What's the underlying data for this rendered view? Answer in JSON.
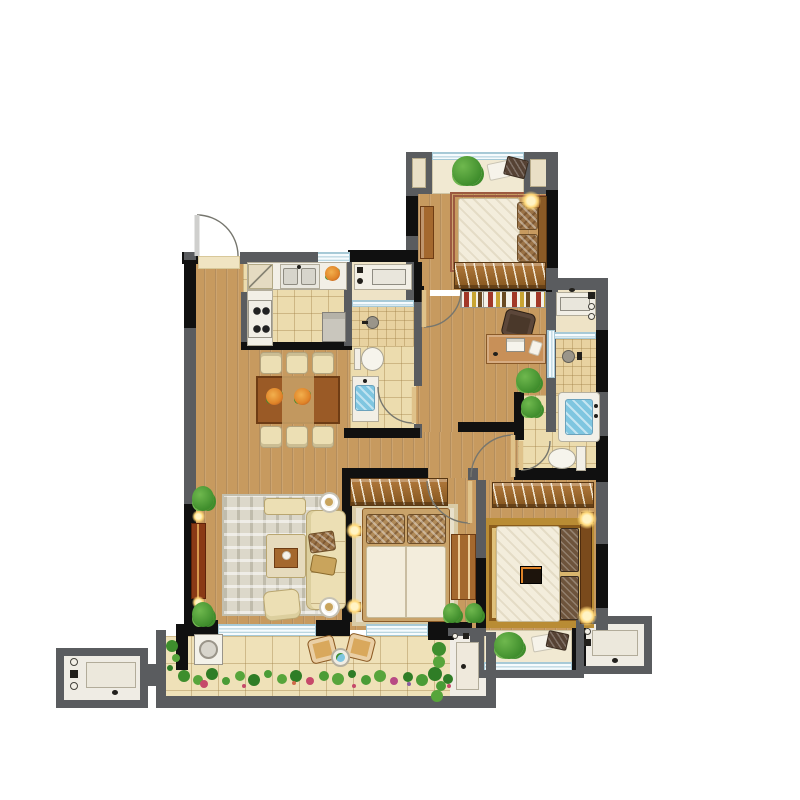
{
  "scene": {
    "type": "residential-apartment-floor-plan",
    "view": "top-down-rendered-plan",
    "visible_text": "none",
    "canvas": {
      "width": 800,
      "height": 800
    }
  },
  "palette": {
    "background": "#ffffff",
    "wall_gray": "#5a5c5f",
    "wall_black": "#101010",
    "wood_floor": "#c79a5f",
    "tile_floor": "#ecdcae",
    "tile_small": "#e8d2a0",
    "balcony_tile": "#efe1b8",
    "bay_marble": "#f1e9d2",
    "counter_white": "#f2efe6",
    "furniture_beige": "#ecdfb4",
    "furniture_wood": "#a4682e",
    "furniture_wood_dark": "#6e3c14",
    "tv_cabinet": "#8a3a16",
    "bedding_white": "#f3eddc",
    "pillow_brown": "#9a7246",
    "pillow_dark": "#564234",
    "rug_master": "#d9b66e",
    "rug_living": "#dcd8ca",
    "plant_green": "#3f8d2c",
    "plant_green_light": "#6fb84e",
    "flower_orange": "#e08428",
    "flower_pink": "#c6496a",
    "water_blue": "#7fc6e0",
    "window_line": "#a6c9d6",
    "window_glass": "#f6fbfd",
    "lamp_glow": "#ffd97a",
    "door_arc": "#76766e",
    "door_leaf": "#dfc28a"
  },
  "rooms": [
    {
      "id": "living-dining-room",
      "floor": "wood",
      "features": [
        "entry-door",
        "dining-table-6-chairs",
        "sofa-set",
        "coffee-table",
        "tv-cabinet",
        "area-rug",
        "balcony-sliding-door"
      ]
    },
    {
      "id": "kitchen",
      "floor": "tile",
      "features": [
        "double-sink",
        "4-burner-stove",
        "cabinet",
        "appliance"
      ]
    },
    {
      "id": "bathroom-1",
      "floor": "tile",
      "features": [
        "vanity",
        "glass-partition",
        "shower",
        "toilet",
        "basin-counter"
      ]
    },
    {
      "id": "bedroom-top-right",
      "floor": "wood",
      "features": [
        "bay-window",
        "double-bed",
        "wardrobe",
        "side-cabinet",
        "lamp"
      ]
    },
    {
      "id": "study",
      "floor": "wood",
      "features": [
        "bookshelf",
        "desk",
        "chair",
        "plant"
      ]
    },
    {
      "id": "hallway",
      "floor": "wood",
      "features": []
    },
    {
      "id": "bedroom-middle",
      "floor": "wood",
      "features": [
        "wardrobe",
        "double-bed",
        "rug",
        "lamps",
        "dresser",
        "window"
      ]
    },
    {
      "id": "master-bedroom",
      "floor": "wood",
      "features": [
        "wardrobe",
        "double-bed",
        "patterned-rug",
        "lamps",
        "bay-window"
      ]
    },
    {
      "id": "master-bathroom",
      "floor": "tile",
      "features": [
        "vanity",
        "glass-partition",
        "shower",
        "bathtub",
        "toilet",
        "plants"
      ]
    },
    {
      "id": "balcony",
      "floor": "large-tile",
      "features": [
        "washing-machine",
        "two-chairs",
        "round-table",
        "flower-bed",
        "utility-sink"
      ]
    },
    {
      "id": "equipment-platform-left",
      "floor": "white",
      "features": [
        "counter-sink"
      ]
    },
    {
      "id": "equipment-platform-right",
      "floor": "white",
      "features": [
        "counter-sink"
      ]
    }
  ],
  "doors": [
    "entry-door",
    "bedroom-top-right-door",
    "bathroom-1-door",
    "bedroom-middle-door",
    "master-bedroom-door",
    "master-bathroom-door"
  ],
  "windows": [
    "bay-window-top",
    "kitchen-window",
    "bathroom-1-glass",
    "study-glass",
    "master-bath-glass",
    "balcony-sliding-door",
    "bedroom-middle-window",
    "master-bay-window"
  ]
}
